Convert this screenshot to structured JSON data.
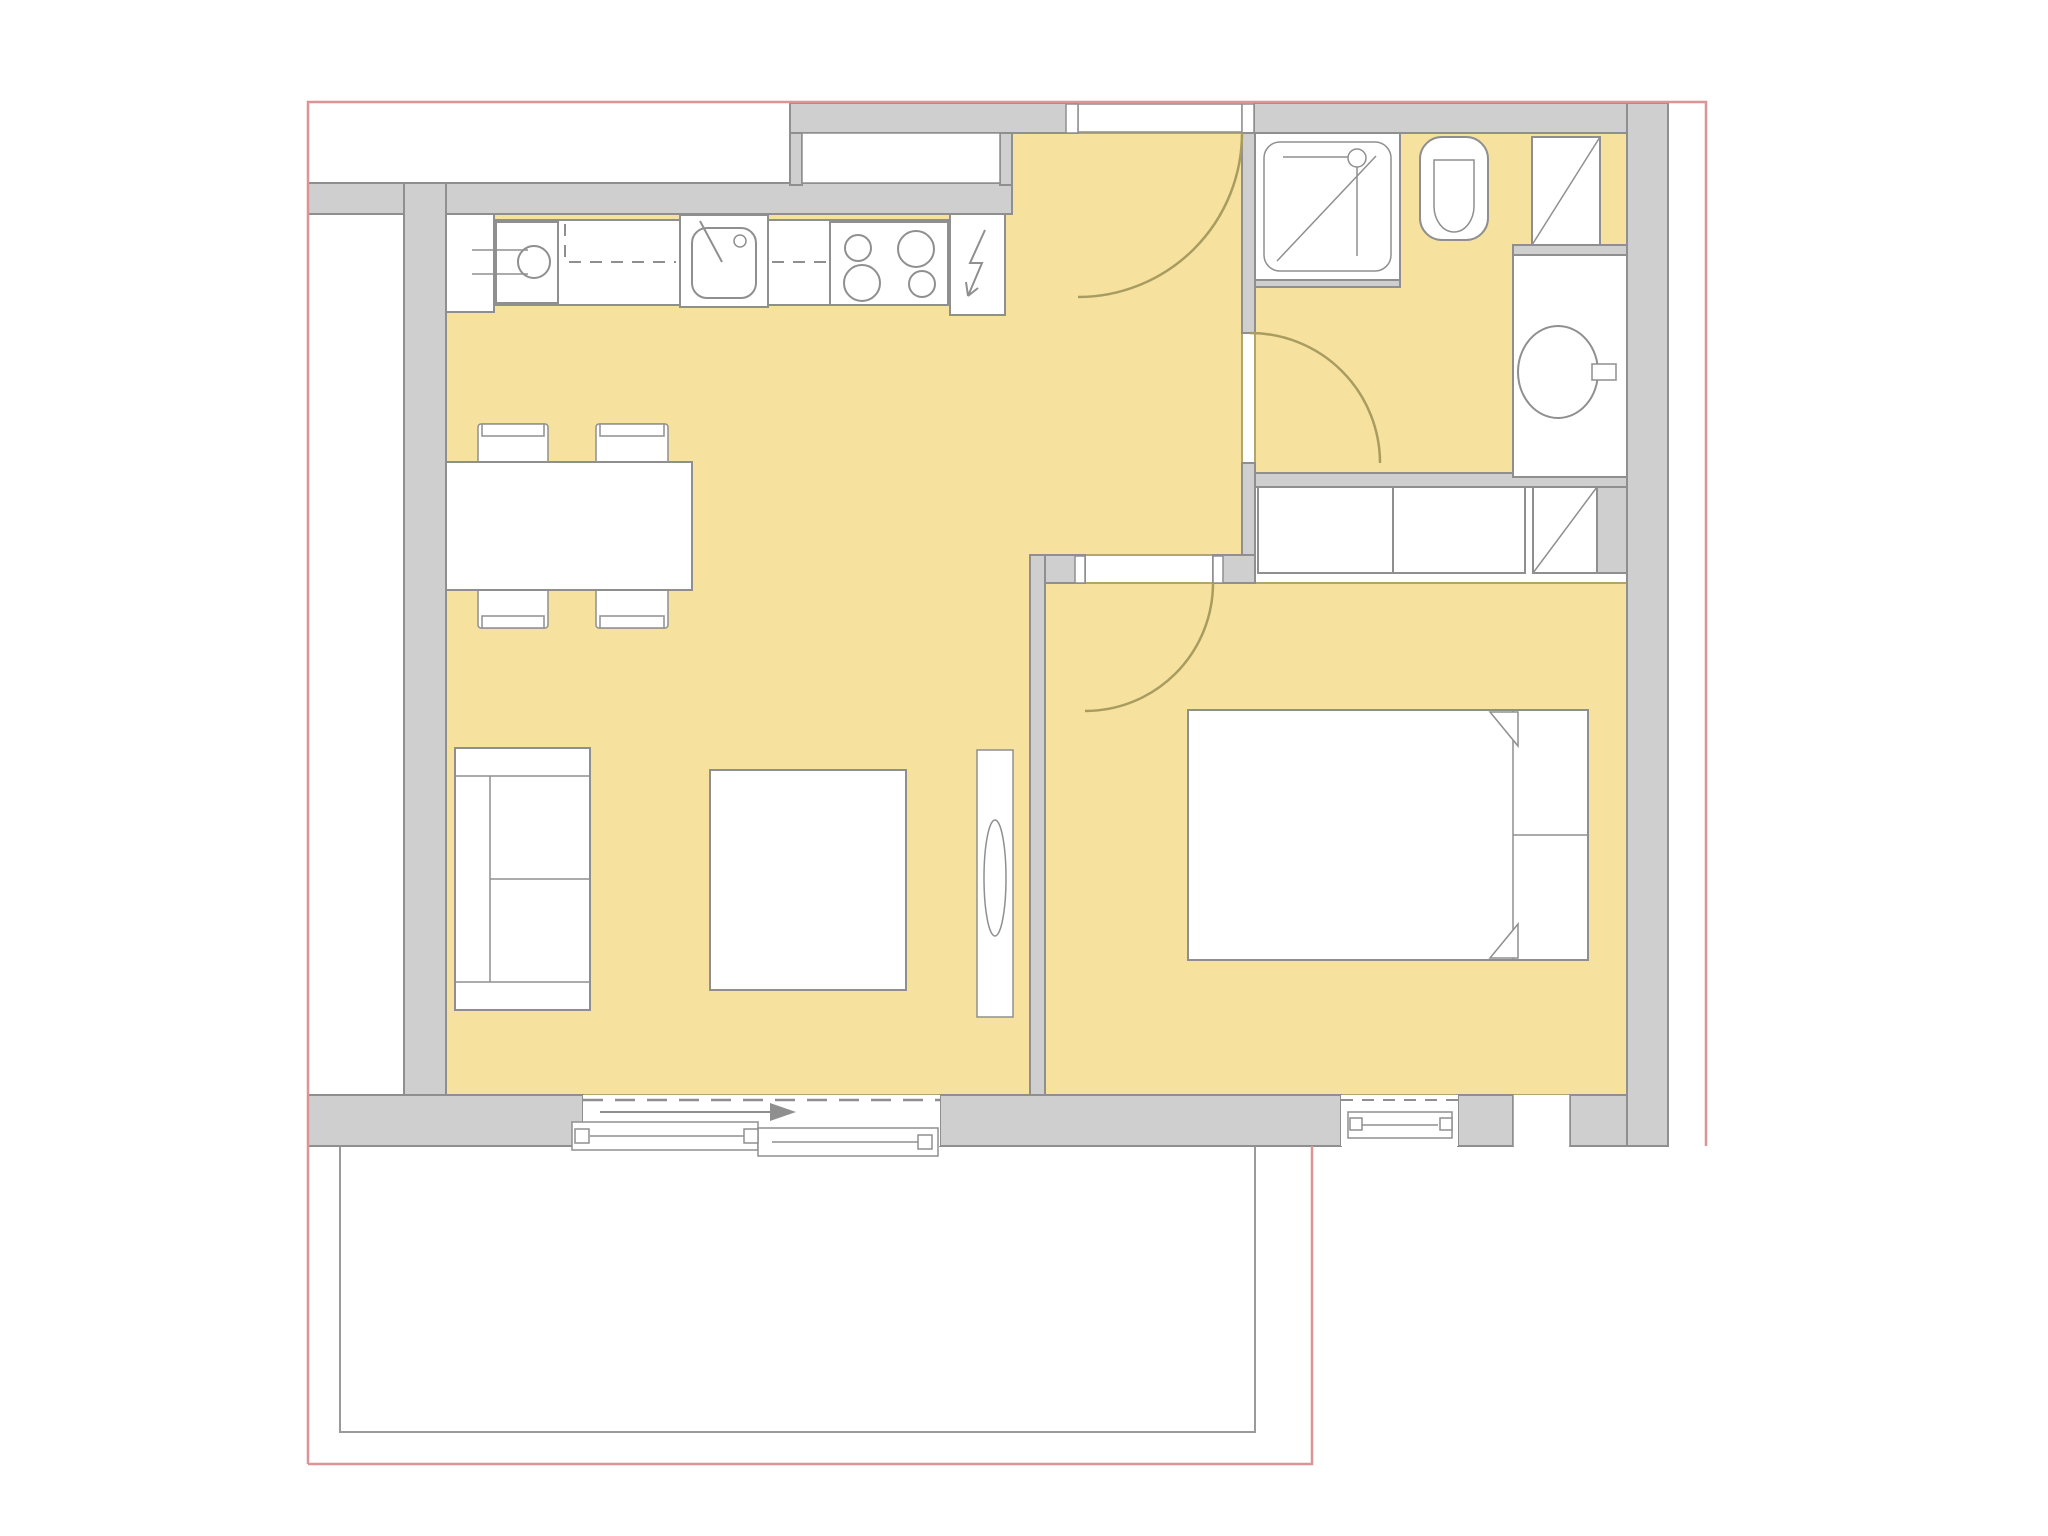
{
  "title": "Apartment floor plan with highlighted living area and balcony",
  "colors": {
    "background": "#ffffff",
    "floor": "#f6e19e",
    "floor_border": "#b3a66a",
    "wall": "#cfcfcf",
    "wall_border": "#8f8f8f",
    "fixture": "#ffffff",
    "fixture_border": "#8f8f8f",
    "door_arc": "#a89c60",
    "boundary": "#dd9494"
  },
  "rooms": [
    {
      "name": "living-dining-kitchen",
      "highlighted": true
    },
    {
      "name": "entry-hall",
      "highlighted": true
    },
    {
      "name": "bathroom",
      "highlighted": true
    },
    {
      "name": "bedroom",
      "highlighted": true
    },
    {
      "name": "balcony",
      "highlighted": false
    }
  ],
  "fixtures": [
    "kitchen-tall-unit",
    "washing-machine",
    "kitchen-sink",
    "cooktop-4-burners",
    "electrical-panel",
    "dining-table",
    "dining-chair x4",
    "sofa",
    "coffee-table",
    "tv-lowboard",
    "double-bed",
    "pillow x2",
    "wardrobe x2",
    "service-duct x2",
    "shower",
    "toilet",
    "washbasin",
    "entrance-door",
    "bathroom-door",
    "bedroom-door",
    "sliding-balcony-door",
    "bedroom-window",
    "corner-window"
  ],
  "doors": {
    "entrance": 1,
    "bathroom": 1,
    "bedroom": 1,
    "sliding": 1
  },
  "legend": {
    "highlight_meaning": "apartment interior floor area",
    "boundary_meaning": "property / plot outline"
  }
}
